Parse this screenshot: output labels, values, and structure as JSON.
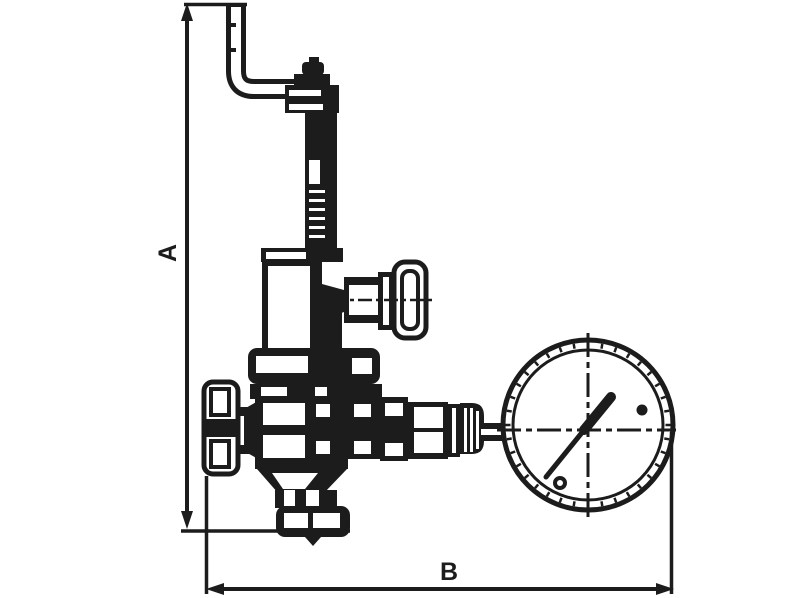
{
  "page": {
    "background": "#ffffff"
  },
  "drawing": {
    "figure_type": "technical line drawing of a pressure reducing valve with pressure gauge",
    "line_color": "#1c1c1c",
    "labels": {
      "dim_a": "A",
      "dim_b": "B"
    }
  }
}
